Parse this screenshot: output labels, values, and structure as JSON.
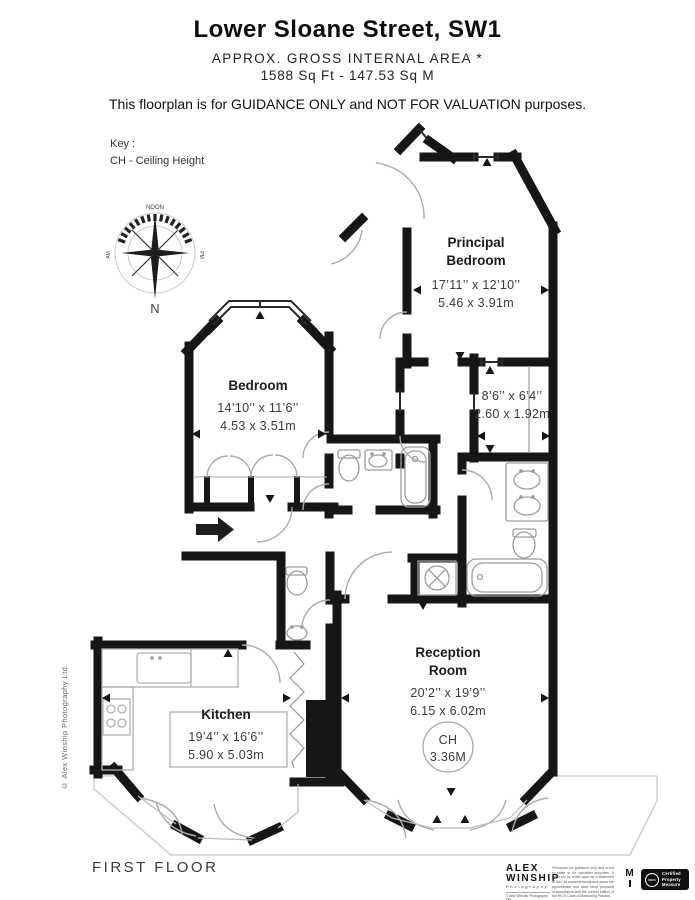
{
  "header": {
    "title": "Lower Sloane Street, SW1",
    "subtitle": "APPROX. GROSS INTERNAL  AREA *",
    "area_line": "1588 Sq Ft  -  147.53 Sq M",
    "guidance": "This floorplan is for GUIDANCE ONLY and NOT FOR VALUATION purposes."
  },
  "key": {
    "title": "Key :",
    "ch": "CH - Ceiling Height"
  },
  "compass": {
    "top": "NOON",
    "bottom": "N",
    "left": "AM",
    "right": "PM"
  },
  "rooms": {
    "principal_bedroom": {
      "name1": "Principal",
      "name2": "Bedroom",
      "imperial": "17’11’’ x 12’10’’",
      "metric": "5.46 x 3.91m"
    },
    "bedroom": {
      "name": "Bedroom",
      "imperial": "14’10’’ x 11’6’’",
      "metric": "4.53 x 3.51m"
    },
    "dressing": {
      "imperial": "8’6’’ x 6’4’’",
      "metric": "2.60 x 1.92m"
    },
    "kitchen": {
      "name": "Kitchen",
      "imperial": "19’4’’ x 16’6’’",
      "metric": "5.90 x 5.03m"
    },
    "reception": {
      "name1": "Reception",
      "name2": "Room",
      "imperial": "20’2’’ x 19’9’’",
      "metric": "6.15 x 6.02m",
      "ch_label": "CH",
      "ch_value": "3.36M"
    }
  },
  "footer": {
    "floor_label": "FIRST FLOOR",
    "side_copyright": "© Alex Winship Photography Ltd.",
    "brand": {
      "line1": "ALEX",
      "line2": "WINSHIP",
      "line3": "Photography",
      "line4": "© Alex Winship Photography Ltd"
    },
    "disclaimer": "*Floorplan for guidance only and is not to scale or for valuation purposes. It must not be relied upon as a statement of fact. All measurements and areas are approximate and have been prepared in accordance with the current edition of the RICS Code of Measuring Practice.",
    "m_mark": "M",
    "rics": {
      "logo": "RICS",
      "line1": "Certified",
      "line2": "Property",
      "line3": "Measure"
    }
  },
  "colors": {
    "wall": "#161616",
    "fixture": "#9c9c9c",
    "door": "#ababab",
    "terrace": "#cfcfcf"
  }
}
